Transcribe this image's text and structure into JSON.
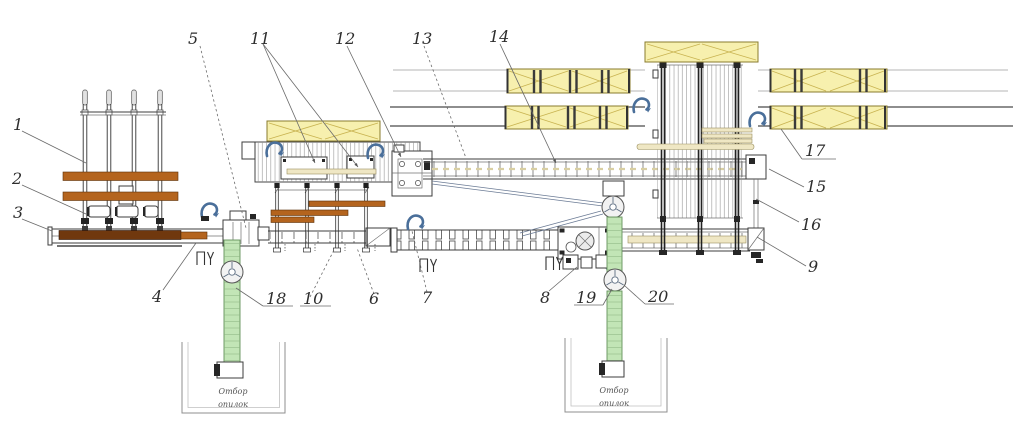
{
  "diagram": {
    "type": "engineering-plan-lumber-sorting-line",
    "callouts": {
      "c1": "1",
      "c2": "2",
      "c3": "3",
      "c4": "4",
      "c5": "5",
      "c6": "6",
      "c7": "7",
      "c8": "8",
      "c9": "9",
      "c10": "10",
      "c11": "11",
      "c12": "12",
      "c13": "13",
      "c14": "14",
      "c15": "15",
      "c16": "16",
      "c17": "17",
      "c18": "18",
      "c19": "19",
      "c20": "20"
    },
    "pit_labels": {
      "left": {
        "line1": "Отбор",
        "line2": "опилок"
      },
      "right": {
        "line1": "Отбор",
        "line2": "опилок"
      }
    },
    "colors": {
      "beam_orange": "#b4641e",
      "log_brown": "#70380e",
      "panel_cream": "#f7f0ae",
      "panel_cream_line": "#c9b452",
      "board_cream": "#efe7c4",
      "conveyor_green": "#c2e5b6",
      "conveyor_green_edge": "#63915a",
      "hook_blue": "#4a6f9a",
      "line_dark": "#3c3c3c",
      "line_mid": "#707070",
      "line_light": "#b5b5b5",
      "background": "#ffffff"
    }
  }
}
